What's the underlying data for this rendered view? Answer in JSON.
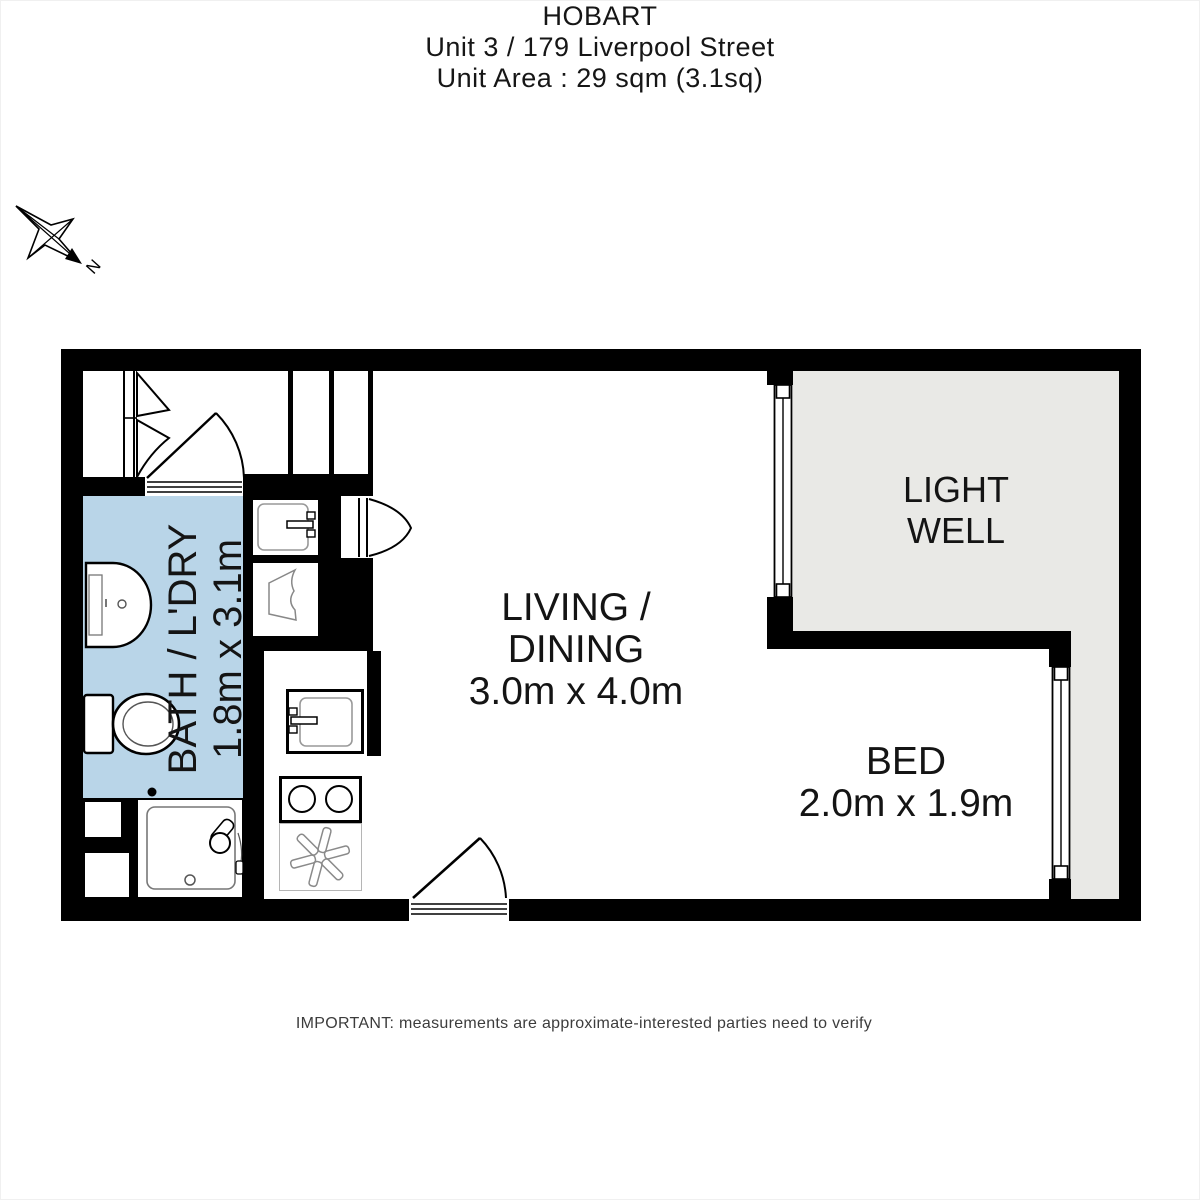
{
  "title": {
    "line1": "HOBART",
    "line2": "Unit 3 / 179 Liverpool Street",
    "line3": "Unit Area : 29 sqm (3.1sq)"
  },
  "compass": {
    "label": "N"
  },
  "rooms": {
    "bath": {
      "name": "BATH / L'DRY",
      "dims": "1.8m x 3.1m"
    },
    "living": {
      "name_line1": "LIVING /",
      "name_line2": "DINING",
      "dims": "3.0m x 4.0m"
    },
    "bed": {
      "name": "BED",
      "dims": "2.0m x 1.9m"
    },
    "light_well": {
      "name_line1": "LIGHT",
      "name_line2": "WELL"
    }
  },
  "footer": {
    "disclaimer": "IMPORTANT: measurements are approximate-interested parties need to verify"
  },
  "fixture_icons": [
    "toilet-icon",
    "bath-basin-icon",
    "vanity-basin-icon",
    "laundry-trough-icon",
    "kitchen-sink-icon",
    "cooktop-icon",
    "extractor-fan-icon",
    "shower-icon",
    "bifold-door-icon",
    "entry-door-icon",
    "internal-door-icon",
    "window-icon",
    "compass-north-icon"
  ],
  "colors": {
    "wall": "#000000",
    "bath_fill": "#b9d5e8",
    "light_well_fill": "#e9e9e6",
    "fixture_line": "#909090",
    "text": "#1b1b1b",
    "background": "#ffffff"
  }
}
